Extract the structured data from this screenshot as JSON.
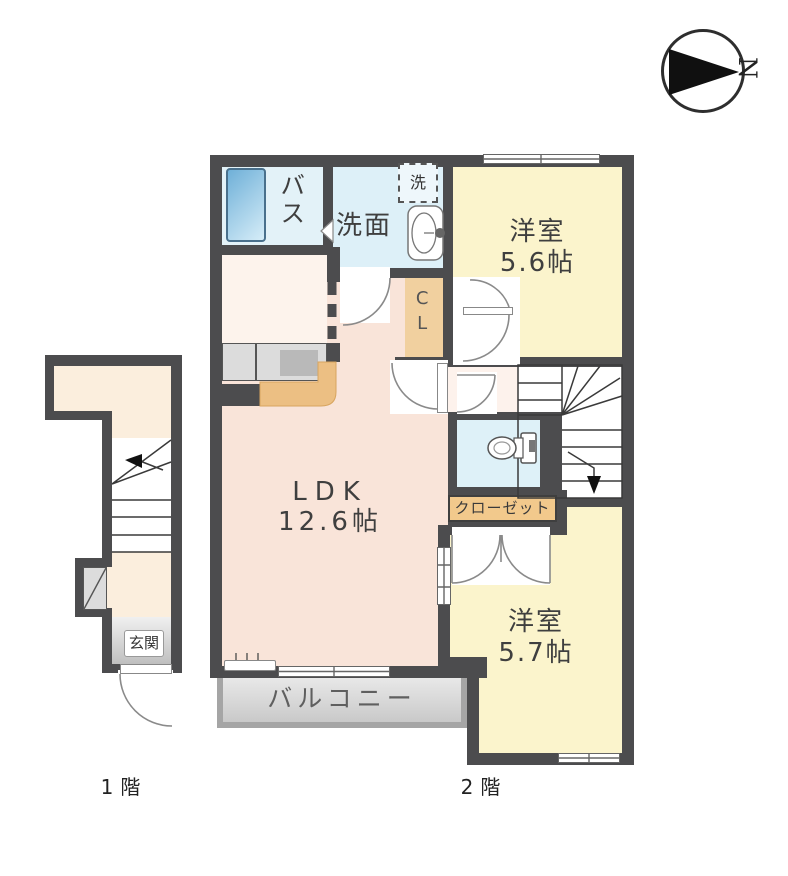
{
  "title": "apartment-floor-plan",
  "compass": {
    "north_label": "N"
  },
  "floor1": {
    "caption": "1階",
    "entrance_label": "玄関"
  },
  "floor2": {
    "caption": "2階",
    "bath_label": "バス",
    "washroom_label": "洗面",
    "washer_label": "洗",
    "closet_cl_label": "CL",
    "room_ne": {
      "name": "洋室",
      "size": "5.6帖"
    },
    "ldk": {
      "name": "LDK",
      "size": "12.6帖"
    },
    "closet_label": "クローゼット",
    "room_se": {
      "name": "洋室",
      "size": "5.7帖"
    },
    "balcony_label": "バルコニー"
  },
  "colors": {
    "wall": "#4c4c4e",
    "room_yellow": "#fbf4cc",
    "room_pink": "#f9e4d9",
    "room_blue": "#ddf0f8",
    "closet_tan": "#f1d09f",
    "hall_cream": "#fbeedd",
    "balcony_gray": "#d6d6d6",
    "tub_blue": "#6fb0d8"
  }
}
